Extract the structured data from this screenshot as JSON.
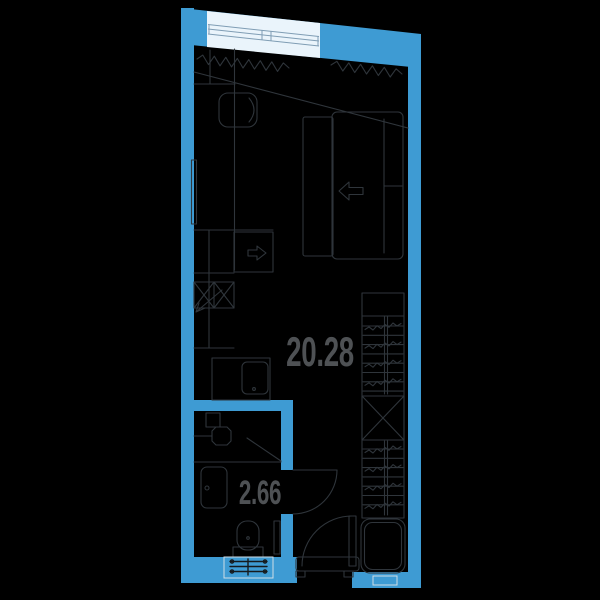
{
  "plan": {
    "type": "apartment-floor-plan",
    "rooms": [
      {
        "id": "living-area",
        "area_label": "20.28"
      },
      {
        "id": "bathroom",
        "area_label": "2.66"
      }
    ],
    "colors": {
      "background": "#000000",
      "wall": "#3e9bd3",
      "line": "#2f353b",
      "label": "#4e5154",
      "window_fill": "#eaf4fb",
      "window_frame": "#7f9db4",
      "light_outline": "#cfdde6"
    },
    "furniture": {
      "living_area": [
        "window",
        "radiator",
        "desk",
        "desk-chair",
        "wall-tv",
        "kitchen-counter",
        "dishwasher",
        "cooktop-sink",
        "refrigerator",
        "double-bed",
        "wardrobe",
        "washing-machine"
      ],
      "bathroom": [
        "shower-shelf",
        "shower-head",
        "shower-glass",
        "vanity-sink",
        "toilet",
        "towel-rail"
      ],
      "doors": [
        "bathroom-door",
        "entrance-door"
      ]
    }
  }
}
